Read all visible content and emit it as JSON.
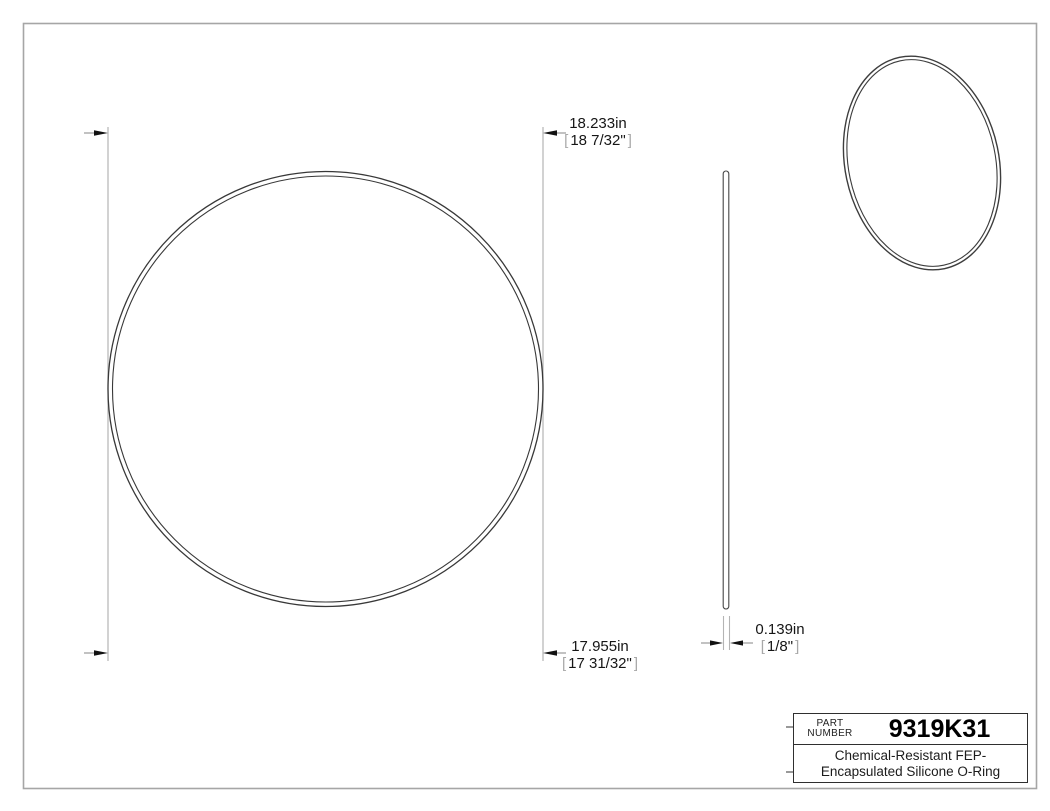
{
  "colors": {
    "page_border": "#a6a6a6",
    "extension_line": "#b4b4b4",
    "part_outline": "#3a3a3a",
    "arrow": "#111111",
    "text": "#161616",
    "bracket": "#a8a8a8"
  },
  "symbols": {
    "bracket_open": "[",
    "bracket_close": "]"
  },
  "dimensions": {
    "outer_diameter": {
      "value": "18.233in",
      "fraction": "18 7/32\""
    },
    "inner_diameter": {
      "value": "17.955in",
      "fraction": "17 31/32\""
    },
    "cross_section": {
      "value": "0.139in",
      "fraction": "1/8\""
    }
  },
  "title_block": {
    "part_label": [
      "PART",
      "NUMBER"
    ],
    "part_number": "9319K31",
    "description": [
      "Chemical-Resistant FEP-",
      "Encapsulated Silicone O-Ring"
    ]
  }
}
